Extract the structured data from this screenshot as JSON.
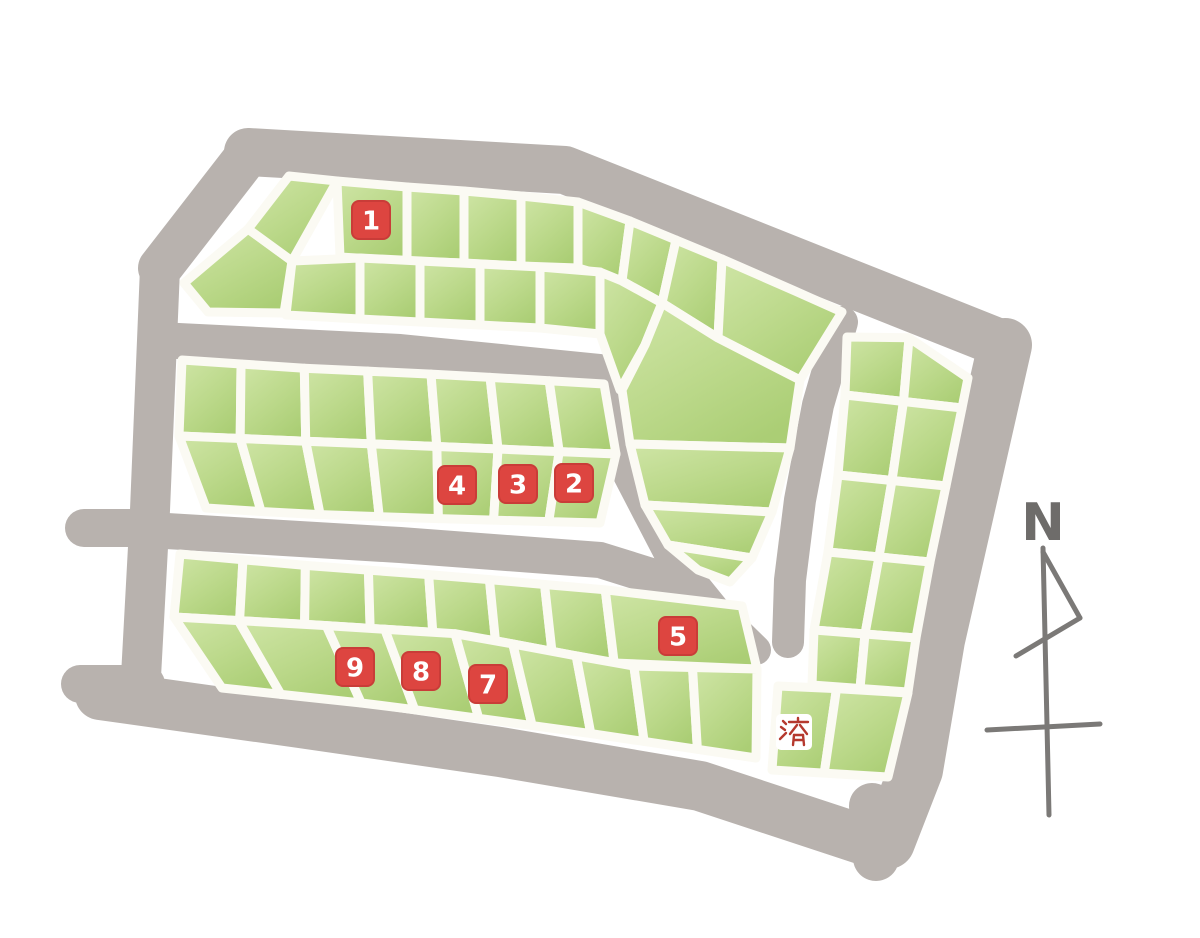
{
  "map": {
    "compass": {
      "label": "N"
    },
    "palette": {
      "background": "#ffffff",
      "road_gray": "#b8b2ae",
      "lot_green_light": "#cde4a3",
      "lot_green_dark": "#aed077",
      "lot_gap_white": "#fbfaf3",
      "marker_red": "#dd4540",
      "marker_red_edge": "#c93c38",
      "marker_text_white": "#ffffff",
      "sold_box_white": "#ffffff",
      "sold_text_red": "#b5392e",
      "compass_gray": "#7b7977",
      "compass_letter_gray": "#6e6c6a"
    },
    "markers": [
      {
        "label": "1",
        "status": "available",
        "x": 371,
        "y": 220
      },
      {
        "label": "2",
        "status": "available",
        "x": 574,
        "y": 483
      },
      {
        "label": "3",
        "status": "available",
        "x": 518,
        "y": 484
      },
      {
        "label": "4",
        "status": "available",
        "x": 457,
        "y": 485
      },
      {
        "label": "5",
        "status": "available",
        "x": 678,
        "y": 636
      },
      {
        "label": "7",
        "status": "available",
        "x": 488,
        "y": 684
      },
      {
        "label": "8",
        "status": "available",
        "x": 421,
        "y": 671
      },
      {
        "label": "9",
        "status": "available",
        "x": 355,
        "y": 667
      },
      {
        "label": "済",
        "status": "sold",
        "x": 794,
        "y": 732
      }
    ],
    "roads": [
      {
        "name": "top-road",
        "w": 48,
        "pts": [
          [
            248,
            152
          ],
          [
            565,
            170
          ],
          [
            1005,
            345
          ]
        ]
      },
      {
        "name": "top-left-diagonal-road",
        "w": 44,
        "pts": [
          [
            250,
            152
          ],
          [
            160,
            268
          ]
        ]
      },
      {
        "name": "left-road",
        "w": 40,
        "pts": [
          [
            160,
            268
          ],
          [
            150,
            510
          ],
          [
            140,
            695
          ]
        ]
      },
      {
        "name": "west-stub-upper",
        "w": 38,
        "pts": [
          [
            84,
            528
          ],
          [
            152,
            528
          ]
        ]
      },
      {
        "name": "west-stub-lower",
        "w": 38,
        "pts": [
          [
            80,
            684
          ],
          [
            146,
            684
          ]
        ]
      },
      {
        "name": "bottom-road",
        "w": 50,
        "pts": [
          [
            100,
            695
          ],
          [
            300,
            723
          ],
          [
            500,
            752
          ],
          [
            700,
            786
          ],
          [
            870,
            842
          ]
        ]
      },
      {
        "name": "right-road",
        "w": 54,
        "pts": [
          [
            1005,
            345
          ],
          [
            938,
            640
          ],
          [
            916,
            770
          ],
          [
            888,
            842
          ]
        ]
      },
      {
        "name": "south-stub",
        "w": 46,
        "pts": [
          [
            872,
            806
          ],
          [
            876,
            858
          ]
        ]
      },
      {
        "name": "inner-road-upper",
        "w": 36,
        "pts": [
          [
            158,
            340
          ],
          [
            400,
            352
          ],
          [
            600,
            372
          ]
        ]
      },
      {
        "name": "inner-road-lower",
        "w": 36,
        "pts": [
          [
            150,
            530
          ],
          [
            400,
            545
          ],
          [
            600,
            560
          ],
          [
            680,
            585
          ]
        ]
      },
      {
        "name": "bend-road",
        "w": 30,
        "pts": [
          [
            606,
            385
          ],
          [
            628,
            475
          ],
          [
            668,
            552
          ],
          [
            715,
            610
          ],
          [
            756,
            650
          ]
        ]
      },
      {
        "name": "east-inner-road",
        "w": 32,
        "pts": [
          [
            842,
            322
          ],
          [
            818,
            405
          ],
          [
            800,
            500
          ],
          [
            790,
            580
          ],
          [
            788,
            642
          ]
        ]
      }
    ],
    "blocks": {
      "hook_block_lots": [
        [
          [
            184,
            283
          ],
          [
            248,
            229
          ],
          [
            292,
            261
          ],
          [
            284,
            313
          ],
          [
            208,
            312
          ]
        ],
        [
          [
            248,
            229
          ],
          [
            289,
            176
          ],
          [
            337,
            181
          ],
          [
            292,
            261
          ]
        ],
        [
          [
            337,
            181
          ],
          [
            407,
            187
          ],
          [
            407,
            261
          ],
          [
            340,
            257
          ]
        ],
        [
          [
            407,
            187
          ],
          [
            464,
            191
          ],
          [
            464,
            263
          ],
          [
            407,
            261
          ]
        ],
        [
          [
            464,
            191
          ],
          [
            521,
            196
          ],
          [
            521,
            266
          ],
          [
            464,
            263
          ]
        ],
        [
          [
            521,
            196
          ],
          [
            578,
            202
          ],
          [
            578,
            268
          ],
          [
            521,
            266
          ]
        ],
        [
          [
            578,
            202
          ],
          [
            630,
            221
          ],
          [
            622,
            281
          ],
          [
            578,
            268
          ]
        ],
        [
          [
            630,
            221
          ],
          [
            676,
            240
          ],
          [
            662,
            303
          ],
          [
            622,
            281
          ]
        ],
        [
          [
            676,
            240
          ],
          [
            722,
            259
          ],
          [
            718,
            338
          ],
          [
            662,
            303
          ]
        ],
        [
          [
            722,
            259
          ],
          [
            795,
            291
          ],
          [
            842,
            312
          ],
          [
            800,
            380
          ],
          [
            718,
            338
          ]
        ],
        [
          [
            292,
            261
          ],
          [
            360,
            258
          ],
          [
            360,
            319
          ],
          [
            286,
            315
          ]
        ],
        [
          [
            360,
            258
          ],
          [
            420,
            261
          ],
          [
            420,
            322
          ],
          [
            360,
            319
          ]
        ],
        [
          [
            420,
            261
          ],
          [
            480,
            264
          ],
          [
            480,
            325
          ],
          [
            420,
            322
          ]
        ],
        [
          [
            480,
            264
          ],
          [
            540,
            267
          ],
          [
            540,
            328
          ],
          [
            480,
            325
          ]
        ],
        [
          [
            540,
            267
          ],
          [
            600,
            272
          ],
          [
            600,
            334
          ],
          [
            540,
            328
          ]
        ],
        [
          [
            600,
            272
          ],
          [
            622,
            281
          ],
          [
            662,
            303
          ],
          [
            645,
            345
          ],
          [
            620,
            390
          ],
          [
            600,
            334
          ]
        ],
        [
          [
            662,
            303
          ],
          [
            718,
            338
          ],
          [
            800,
            380
          ],
          [
            790,
            448
          ],
          [
            630,
            444
          ],
          [
            622,
            390
          ],
          [
            645,
            345
          ]
        ],
        [
          [
            630,
            444
          ],
          [
            790,
            448
          ],
          [
            772,
            512
          ],
          [
            645,
            505
          ]
        ],
        [
          [
            645,
            505
          ],
          [
            772,
            512
          ],
          [
            752,
            558
          ],
          [
            668,
            545
          ]
        ],
        [
          [
            668,
            545
          ],
          [
            752,
            558
          ],
          [
            730,
            582
          ],
          [
            698,
            570
          ]
        ]
      ],
      "middle_block_strips": [
        {
          "top": [
            [
              182,
              360
            ],
            [
              300,
              368
            ],
            [
              450,
              375
            ],
            [
              604,
              384
            ]
          ],
          "bottom": [
            [
              179,
              436
            ],
            [
              300,
              441
            ],
            [
              450,
              447
            ],
            [
              616,
              454
            ]
          ],
          "cols": [
            0,
            0.14,
            0.29,
            0.44,
            0.59,
            0.73,
            0.87,
            1
          ]
        },
        {
          "top": [
            [
              179,
              436
            ],
            [
              300,
              441
            ],
            [
              450,
              447
            ],
            [
              616,
              454
            ]
          ],
          "bottom": [
            [
              206,
              508
            ],
            [
              300,
              514
            ],
            [
              450,
              519
            ],
            [
              600,
              523
            ]
          ],
          "cols": [
            0,
            0.14,
            0.29,
            0.44,
            0.59,
            0.73,
            0.87,
            1
          ]
        }
      ],
      "bottom_block_strips": [
        {
          "top": [
            [
              180,
              554
            ],
            [
              300,
              565
            ],
            [
              460,
              577
            ],
            [
              630,
              592
            ],
            [
              742,
              606
            ]
          ],
          "bottom": [
            [
              174,
              617
            ],
            [
              300,
              624
            ],
            [
              460,
              634
            ],
            [
              630,
              666
            ],
            [
              757,
              669
            ]
          ],
          "cols": [
            0,
            0.112,
            0.223,
            0.335,
            0.442,
            0.55,
            0.648,
            0.756,
            1
          ]
        },
        {
          "top": [
            [
              174,
              617
            ],
            [
              300,
              624
            ],
            [
              460,
              634
            ],
            [
              630,
              666
            ],
            [
              757,
              669
            ]
          ],
          "bottom": [
            [
              222,
              688
            ],
            [
              380,
              705
            ],
            [
              580,
              732
            ],
            [
              756,
              758
            ]
          ],
          "cols": [
            0,
            0.11,
            0.26,
            0.36,
            0.48,
            0.58,
            0.69,
            0.79,
            0.89,
            1
          ]
        }
      ],
      "right_block_strips": [
        {
          "top": [
            [
              847,
              337
            ],
            [
              883,
              320
            ],
            [
              968,
              378
            ]
          ],
          "bottom": [
            [
              845,
              395
            ],
            [
              962,
              408
            ]
          ],
          "cols": [
            0,
            0.5,
            1
          ]
        },
        {
          "top": [
            [
              845,
              395
            ],
            [
              962,
              408
            ]
          ],
          "bottom": [
            [
              838,
              475
            ],
            [
              946,
              486
            ]
          ],
          "cols": [
            0,
            0.5,
            1
          ]
        },
        {
          "top": [
            [
              838,
              475
            ],
            [
              946,
              486
            ]
          ],
          "bottom": [
            [
              828,
              552
            ],
            [
              930,
              562
            ]
          ],
          "cols": [
            0,
            0.5,
            1
          ]
        },
        {
          "top": [
            [
              828,
              552
            ],
            [
              930,
              562
            ]
          ],
          "bottom": [
            [
              814,
              630
            ],
            [
              916,
              638
            ]
          ],
          "cols": [
            0,
            0.5,
            1
          ]
        },
        {
          "top": [
            [
              814,
              630
            ],
            [
              916,
              638
            ]
          ],
          "bottom": [
            [
              812,
              685
            ],
            [
              908,
              692
            ]
          ],
          "cols": [
            0,
            0.5,
            1
          ]
        },
        {
          "top": [
            [
              778,
              686
            ],
            [
              845,
              689
            ],
            [
              908,
              693
            ]
          ],
          "bottom": [
            [
              772,
              770
            ],
            [
              888,
              777
            ]
          ],
          "cols": [
            0,
            0.45,
            1
          ]
        }
      ]
    },
    "compass_strokes": [
      {
        "pts": [
          [
            1043,
            548
          ],
          [
            1046,
            680
          ],
          [
            1049,
            815
          ]
        ],
        "w": 5
      },
      {
        "pts": [
          [
            1043,
            552
          ],
          [
            1080,
            618
          ]
        ],
        "w": 5
      },
      {
        "pts": [
          [
            1080,
            618
          ],
          [
            1016,
            656
          ]
        ],
        "w": 5
      },
      {
        "pts": [
          [
            987,
            730
          ],
          [
            1100,
            724
          ]
        ],
        "w": 5
      }
    ],
    "sold_glyph_strokes": [
      [
        [
          7,
          7
        ],
        [
          10,
          10
        ]
      ],
      [
        [
          5,
          13
        ],
        [
          9,
          16
        ]
      ],
      [
        [
          4,
          25
        ],
        [
          10,
          19
        ]
      ],
      [
        [
          13,
          8
        ],
        [
          32,
          8
        ]
      ],
      [
        [
          22,
          4
        ],
        [
          22,
          8
        ]
      ],
      [
        [
          21,
          11
        ],
        [
          14,
          20
        ]
      ],
      [
        [
          24,
          11
        ],
        [
          31,
          20
        ]
      ],
      [
        [
          18,
          21
        ],
        [
          17,
          31
        ]
      ],
      [
        [
          27,
          21
        ],
        [
          28,
          31
        ]
      ],
      [
        [
          18,
          21
        ],
        [
          27,
          21
        ]
      ],
      [
        [
          18,
          26
        ],
        [
          27,
          26
        ]
      ]
    ]
  }
}
